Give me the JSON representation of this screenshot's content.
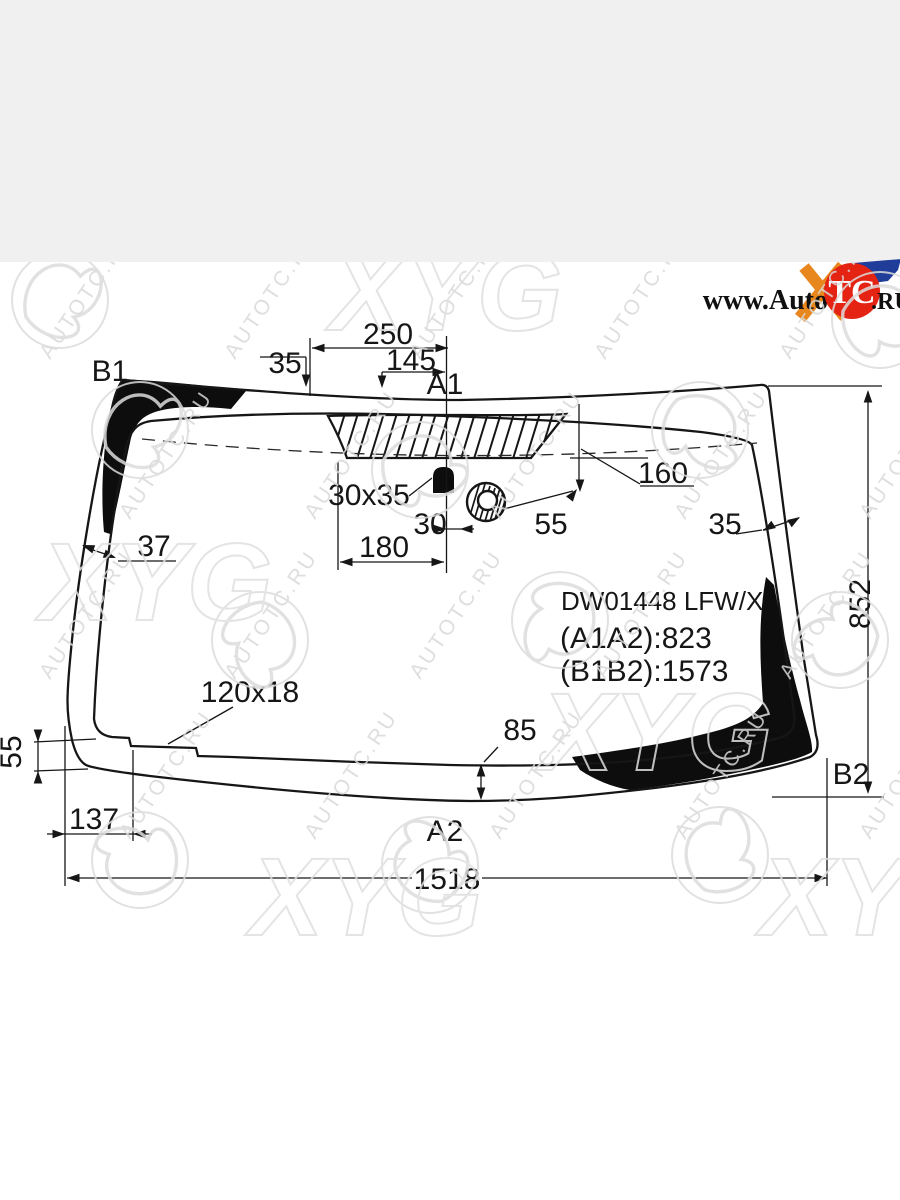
{
  "page": {
    "top_band_color": "#f0f0f1"
  },
  "logo": {
    "prefix": "www.Auto",
    "circle_text": "TC",
    "suffix": ".RU",
    "circle_color": "#e42313",
    "orange": "#e8871e",
    "blue": "#1f3d99"
  },
  "part": {
    "code": "DW01448 LFW/X",
    "a1a2": "(A1A2):823",
    "b1b2": "(B1B2):1573"
  },
  "labels": {
    "b1": "B1",
    "a1": "A1",
    "a2": "A2",
    "b2": "B2"
  },
  "dimensions": {
    "top_offset": "35",
    "top_width": "250",
    "top_width2": "145",
    "hatch_to_edge": "160",
    "right_edge_width": "35",
    "mount_size": "30x35",
    "mount_offset": "30",
    "sensor_offset": "55",
    "mount_span": "180",
    "left_edge_width": "37",
    "height": "852",
    "notch_size": "120x18",
    "left_corner_height": "55",
    "bottom_edge_width": "85",
    "bottom_corner_offset": "137",
    "width": "1518"
  },
  "watermark": {
    "text": "AUTOTC.RU",
    "logo": "XYG"
  }
}
